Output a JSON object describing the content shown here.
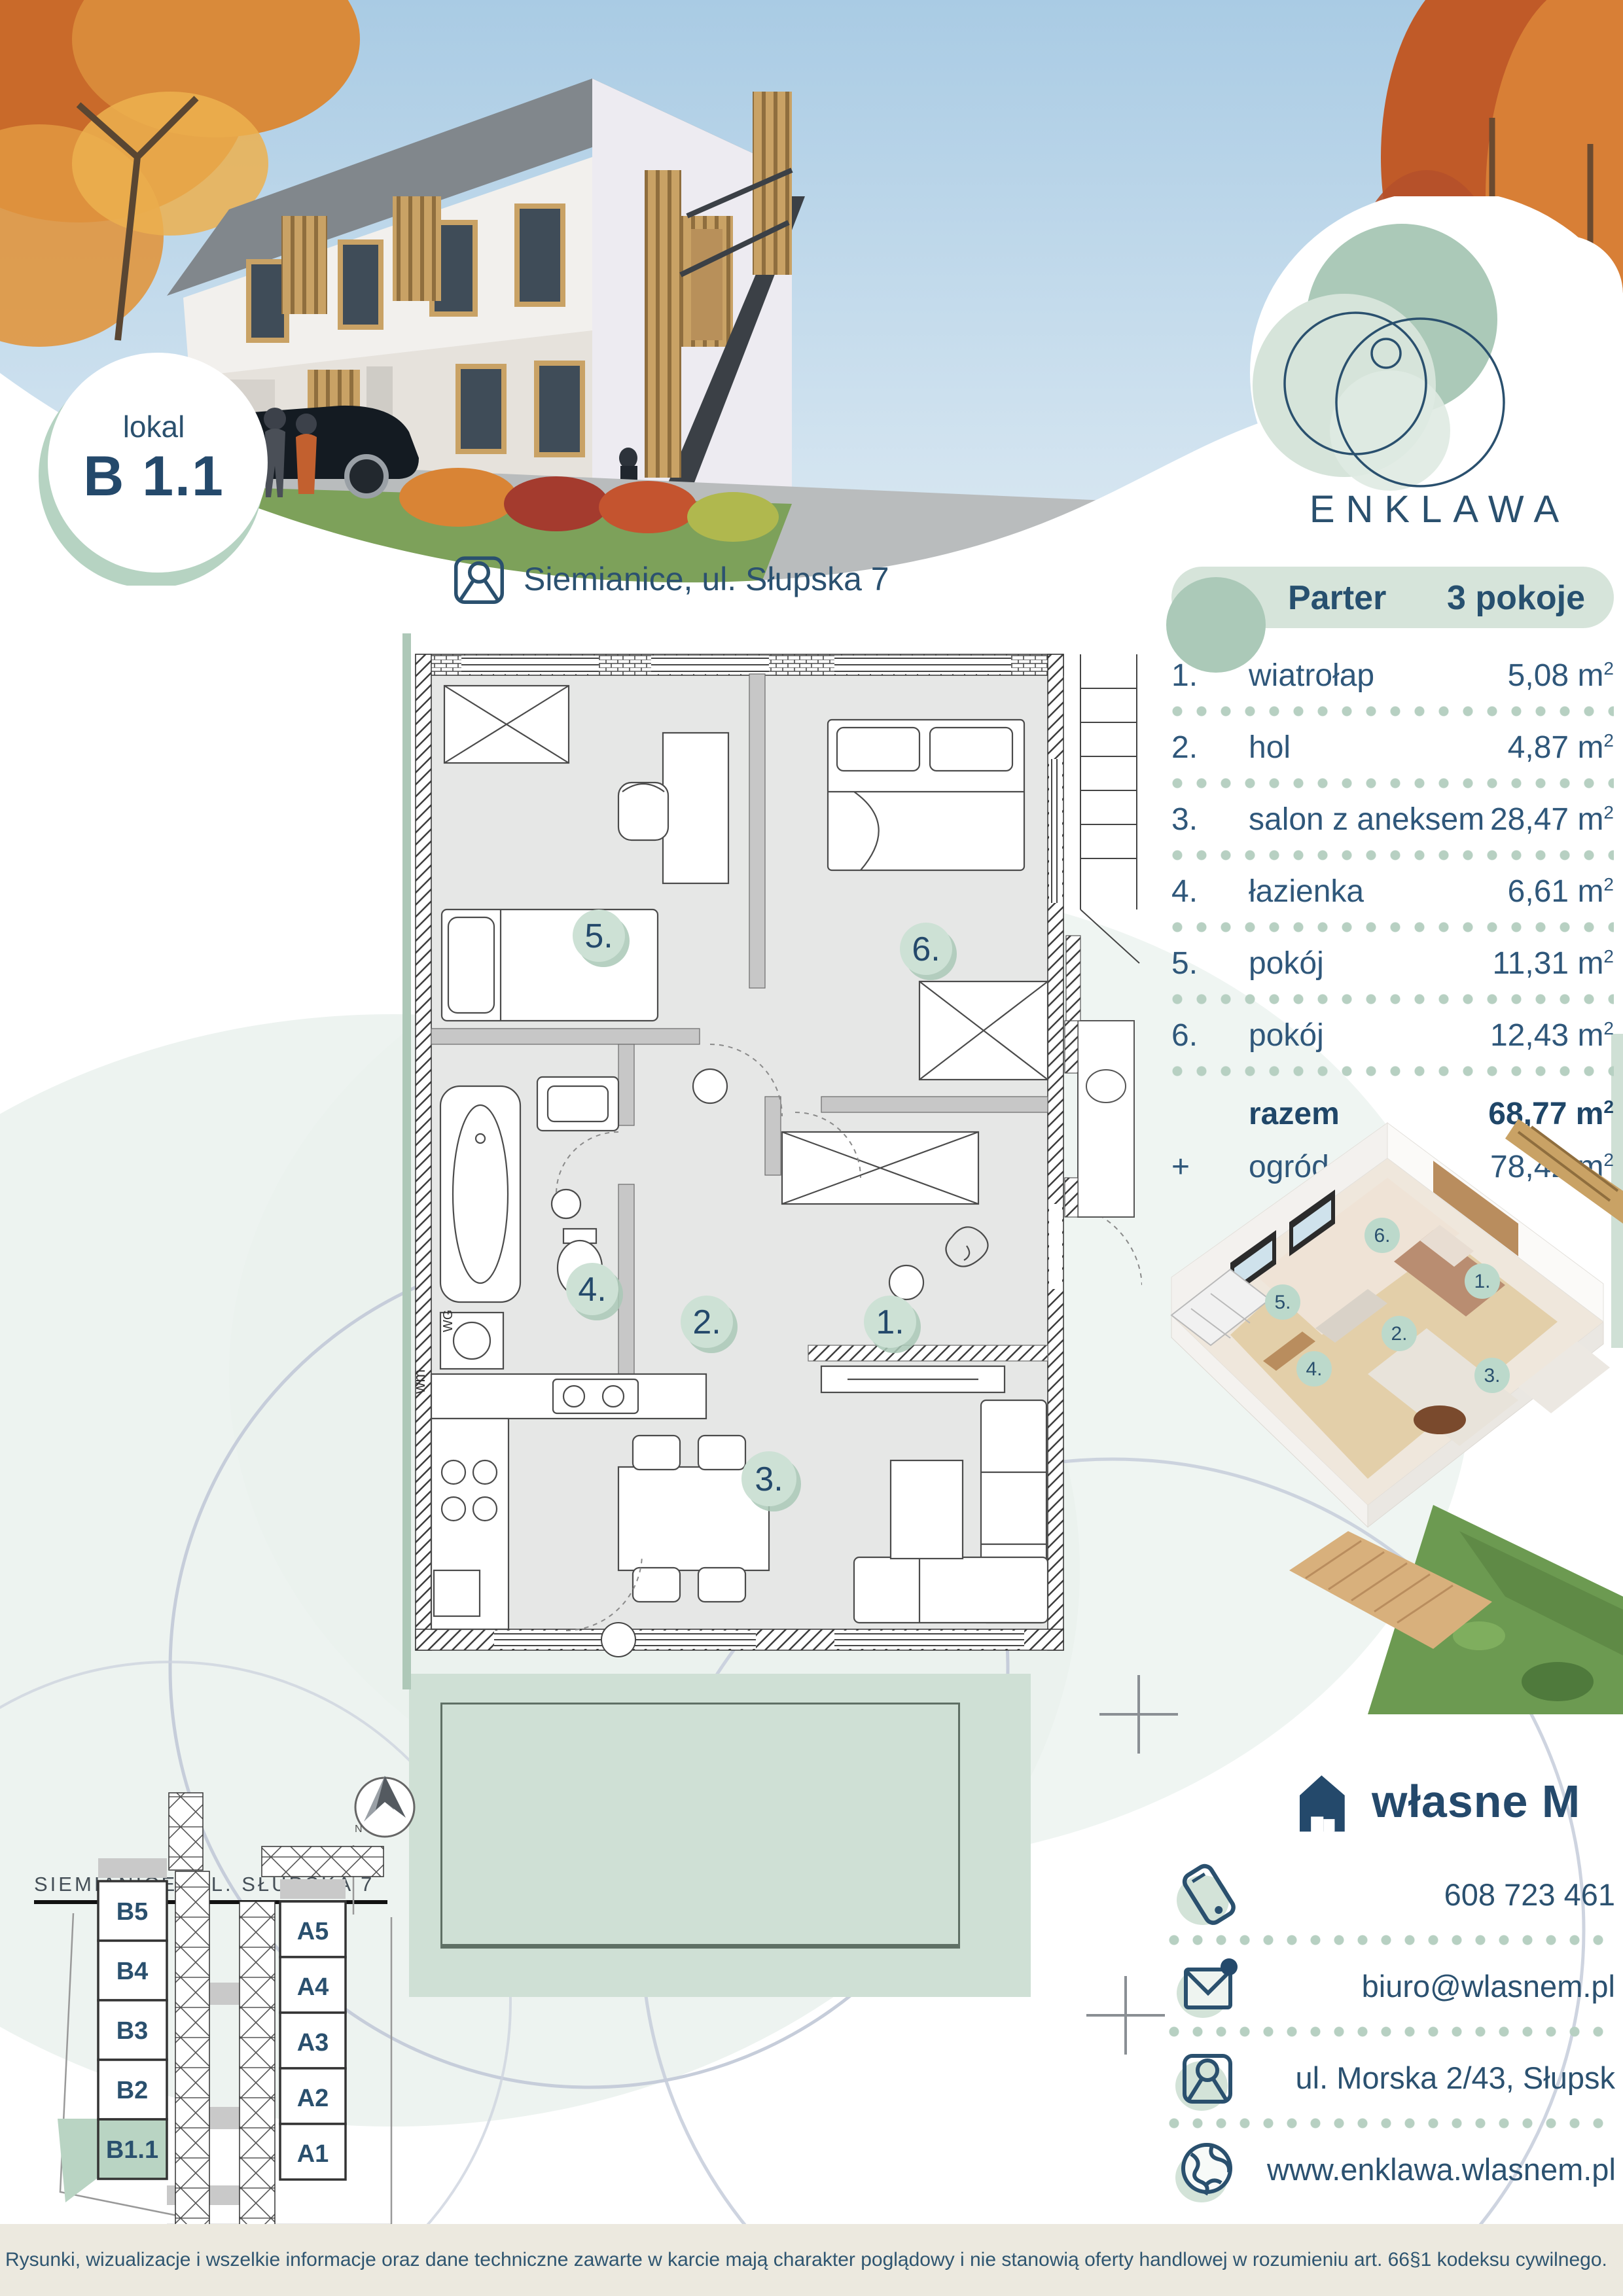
{
  "badge": {
    "label": "lokal",
    "unit": "B 1.1"
  },
  "logo": {
    "name": "ENKLAWA"
  },
  "location": {
    "text": "Siemianice, ul. Słupska 7"
  },
  "rooms": {
    "header": {
      "floor": "Parter",
      "count": "3 pokoje"
    },
    "unit": "m",
    "sup": "2",
    "items": [
      {
        "no": "1.",
        "name": "wiatrołap",
        "area": "5,08"
      },
      {
        "no": "2.",
        "name": "hol",
        "area": "4,87"
      },
      {
        "no": "3.",
        "name": "salon z aneksem",
        "area": "28,47"
      },
      {
        "no": "4.",
        "name": "łazienka",
        "area": "6,61"
      },
      {
        "no": "5.",
        "name": "pokój",
        "area": "11,31"
      },
      {
        "no": "6.",
        "name": "pokój",
        "area": "12,43"
      }
    ],
    "total": {
      "label": "razem",
      "area": "68,77"
    },
    "extra": {
      "plus": "+",
      "label": "ogród",
      "area": "78,42"
    }
  },
  "plan": {
    "numbers": [
      "1.",
      "2.",
      "3.",
      "4.",
      "5.",
      "6."
    ],
    "labels": {
      "wm": "wm",
      "wg": "WG"
    }
  },
  "siteplan": {
    "title": "SIEMIANICE, UL. SŁUPSKA 7",
    "left_units": [
      "B5",
      "B4",
      "B3",
      "B2",
      "B1.1"
    ],
    "right_units": [
      "A5",
      "A4",
      "A3",
      "A2",
      "A1"
    ],
    "highlighted_unit": "B1.1"
  },
  "contact": {
    "brand": "własne M",
    "phone": "608 723 461",
    "email": "biuro@wlasnem.pl",
    "address": "ul. Morska 2/43, Słupsk",
    "website": "www.enklawa.wlasnem.pl"
  },
  "footer": {
    "disclaimer": "Rysunki, wizualizacje i wszelkie informacje oraz dane techniczne zawarte w karcie mają charakter poglądowy i nie stanowią oferty handlowej w rozumieniu art. 66§1 kodeksu cywilnego."
  },
  "colors": {
    "navy": "#2a506e",
    "sage": "#cfe0d5",
    "sage_dark": "#abc9b8",
    "sage_light": "#d6e4da",
    "footer_beige": "#ece9df",
    "plan_floor": "#e6e7e6"
  }
}
